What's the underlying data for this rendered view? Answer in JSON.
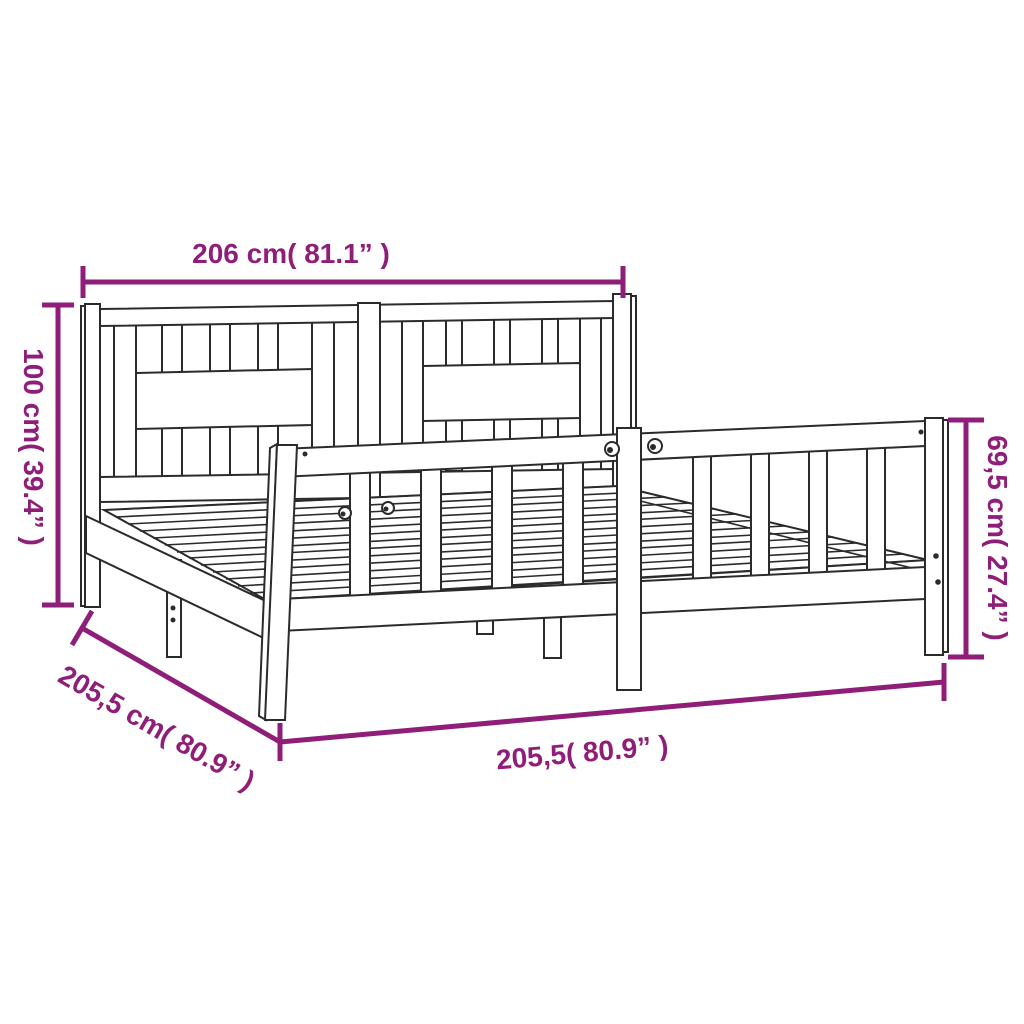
{
  "figure": {
    "name": "bed-frame-with-slatted-headboard-line-drawing",
    "type": "product-dimension-diagram"
  },
  "colors": {
    "dimension": "#8e1e78",
    "outline": "#2b2b2b",
    "background": "#ffffff"
  },
  "dimensions": {
    "width_top": "206 cm( 81.1” )",
    "height_left": "100 cm( 39.4” )",
    "height_right": "69,5 cm( 27.4” )",
    "length_bottom": "205,5( 80.9” )",
    "length_diagonal": "205,5 cm( 80.9” )"
  }
}
